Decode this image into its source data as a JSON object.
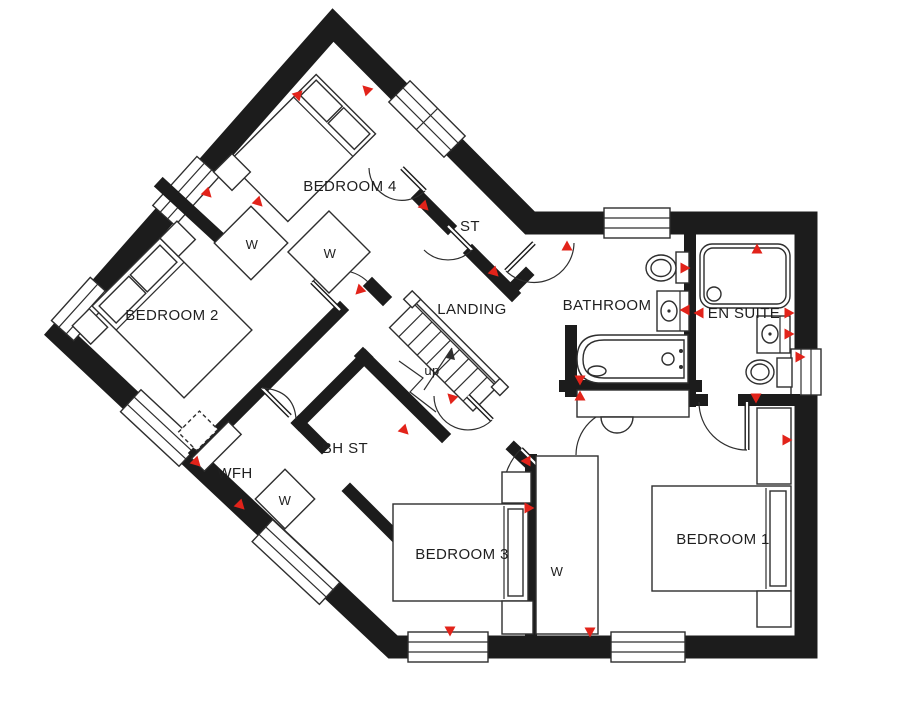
{
  "labels": {
    "bedroom1": "BEDROOM 1",
    "bedroom2": "BEDROOM 2",
    "bedroom3": "BEDROOM 3",
    "bedroom4": "BEDROOM 4",
    "bathroom": "BATHROOM",
    "ensuite": "EN SUITE",
    "landing": "LANDING",
    "store": "ST",
    "bulkhead_store": "BH ST",
    "wfh": "WFH",
    "stairs_up": "up",
    "wardrobe": "W"
  },
  "colors": {
    "wall": "#1c1c1c",
    "marker": "#e2231a",
    "line": "#2e2e2e",
    "background": "#ffffff"
  },
  "markers": [
    {
      "x": 298,
      "y": 95,
      "rot": 45
    },
    {
      "x": 367,
      "y": 90,
      "rot": 315
    },
    {
      "x": 207,
      "y": 193,
      "rot": 135
    },
    {
      "x": 258,
      "y": 202,
      "rot": 135
    },
    {
      "x": 360,
      "y": 290,
      "rot": 225
    },
    {
      "x": 494,
      "y": 272,
      "rot": 135
    },
    {
      "x": 424,
      "y": 206,
      "rot": 135
    },
    {
      "x": 567,
      "y": 247,
      "rot": 0
    },
    {
      "x": 757,
      "y": 250,
      "rot": 0
    },
    {
      "x": 684,
      "y": 268,
      "rot": 90
    },
    {
      "x": 700,
      "y": 313,
      "rot": 270
    },
    {
      "x": 788,
      "y": 313,
      "rot": 90
    },
    {
      "x": 686,
      "y": 310,
      "rot": 270
    },
    {
      "x": 788,
      "y": 334,
      "rot": 90
    },
    {
      "x": 799,
      "y": 357,
      "rot": 90
    },
    {
      "x": 756,
      "y": 397,
      "rot": 180
    },
    {
      "x": 786,
      "y": 440,
      "rot": 90
    },
    {
      "x": 580,
      "y": 379,
      "rot": 180
    },
    {
      "x": 580,
      "y": 397,
      "rot": 0
    },
    {
      "x": 452,
      "y": 398,
      "rot": 315
    },
    {
      "x": 404,
      "y": 430,
      "rot": 135
    },
    {
      "x": 528,
      "y": 508,
      "rot": 90
    },
    {
      "x": 527,
      "y": 461,
      "rot": 270
    },
    {
      "x": 196,
      "y": 462,
      "rot": 135
    },
    {
      "x": 240,
      "y": 505,
      "rot": 135
    },
    {
      "x": 450,
      "y": 630,
      "rot": 180
    },
    {
      "x": 590,
      "y": 631,
      "rot": 180
    }
  ]
}
